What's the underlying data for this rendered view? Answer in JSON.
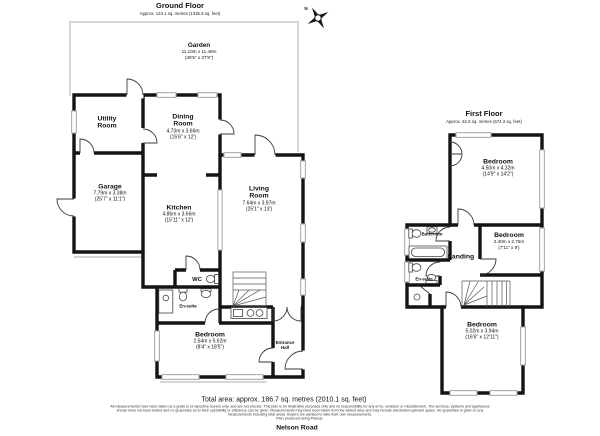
{
  "compass": {
    "north": "N"
  },
  "ground_floor": {
    "title": "Ground Floor",
    "area": "Approx. 124.1 sq. metres (1335.9 sq. feet)",
    "rooms": {
      "garden": {
        "name": "Garden",
        "dim_metric": "11.10m x 11.49m",
        "dim_imperial": "(36'5\" x 37'8\")"
      },
      "utility": {
        "name": "Utility Room"
      },
      "dining": {
        "name": "Dining Room",
        "dim_metric": "4.73m x 3.66m",
        "dim_imperial": "(15'6\" x 12')"
      },
      "garage": {
        "name": "Garage",
        "dim_metric": "7.79m x 3.38m",
        "dim_imperial": "(25'7\" x 11'1\")"
      },
      "kitchen": {
        "name": "Kitchen",
        "dim_metric": "4.86m x 3.66m",
        "dim_imperial": "(15'11\" x 12')"
      },
      "living": {
        "name": "Living Room",
        "dim_metric": "7.64m x 3.97m",
        "dim_imperial": "(25'1\" x 13')"
      },
      "wc": {
        "name": "WC"
      },
      "ensuite": {
        "name": "En-suite"
      },
      "bedroom": {
        "name": "Bedroom",
        "dim_metric": "2.54m x 5.62m",
        "dim_imperial": "(8'4\" x 18'5\")"
      },
      "entrance": {
        "name": "Entrance Hall"
      }
    }
  },
  "first_floor": {
    "title": "First Floor",
    "area": "Approx. 62.6 sq. metres (674.3 sq. feet)",
    "rooms": {
      "bedroom_front": {
        "name": "Bedroom",
        "dim_metric": "4.50m x 4.32m",
        "dim_imperial": "(14'9\" x 14'2\")"
      },
      "bedroom_middle": {
        "name": "Bedroom",
        "dim_metric": "2.40m x 2.75m",
        "dim_imperial": "(7'11\" x 9')"
      },
      "bathroom": {
        "name": "Bathroom"
      },
      "landing": {
        "name": "Landing"
      },
      "ensuite": {
        "name": "En-suite"
      },
      "bedroom_back": {
        "name": "Bedroom",
        "dim_metric": "5.02m x 3.94m",
        "dim_imperial": "(16'6\" x 12'11\")"
      }
    }
  },
  "footer": {
    "total_area": "Total area: approx. 186.7 sq. metres (2010.1 sq. feet)",
    "disclaimer": {
      "line1": "All measurements have been taken as a guide to prospective buyers only, and are not precise. This plan is for illustrative purposes only and no responsibility for any error, omission or misstatement. The services, systems and appliances",
      "line2": "shown have not been tested and no guarantee as to their operability or efficiency can be given. Measurements may have been taken from the widest area and may include wardrobe/cupboard space. No guarantee is given to any",
      "line3": "measurements including total areas. Buyers are advised to take their own measurements.",
      "line4": "Plan produced using PlanUp."
    },
    "address": "Nelson Road"
  }
}
